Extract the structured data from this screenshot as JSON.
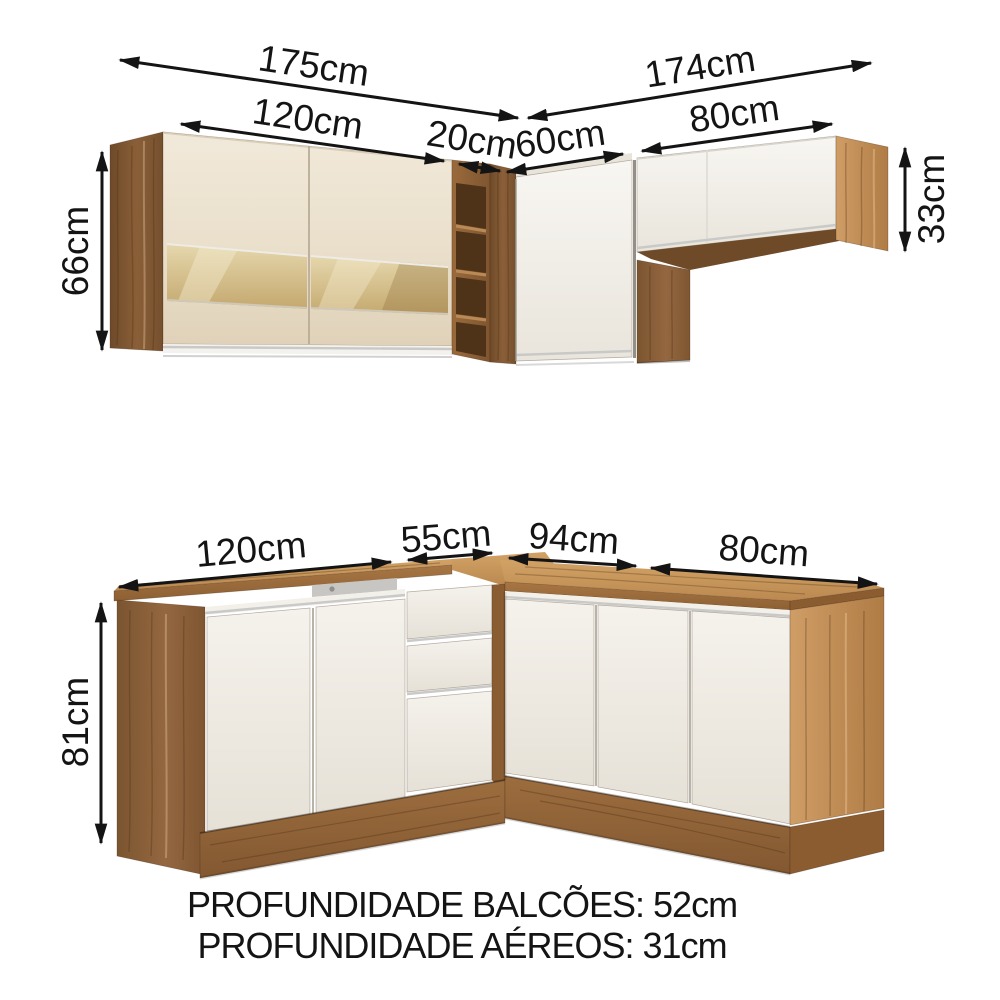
{
  "title": "Kitchen cabinet set dimensions diagram",
  "upper": {
    "w_total_left": "175cm",
    "w_left": "120cm",
    "w_shelf": "20cm",
    "w_total_right": "174cm",
    "w_corner": "60cm",
    "w_right": "80cm",
    "h_left": "66cm",
    "h_right": "33cm"
  },
  "lower": {
    "w_left": "120cm",
    "w_corner": "55cm",
    "w_right_inner": "94cm",
    "w_right": "80cm",
    "h": "81cm"
  },
  "footer": {
    "line1": "PROFUNDIDADE BALCÕES: 52cm",
    "line2": "PROFUNDIDADE AÉREOS: 31cm"
  },
  "colors": {
    "background": "#ffffff",
    "dimension_text": "#141414",
    "wood_side_dark": "#7a5230",
    "wood_frame": "#8a5c31",
    "wood_light": "#c6975f",
    "countertop": "#c08b51",
    "plinth": "#8d6134",
    "door_cream": "#ecdfc9",
    "door_white": "#f3f0ea",
    "glass": "#d9c494",
    "aluminum": "#c9c9c7"
  }
}
